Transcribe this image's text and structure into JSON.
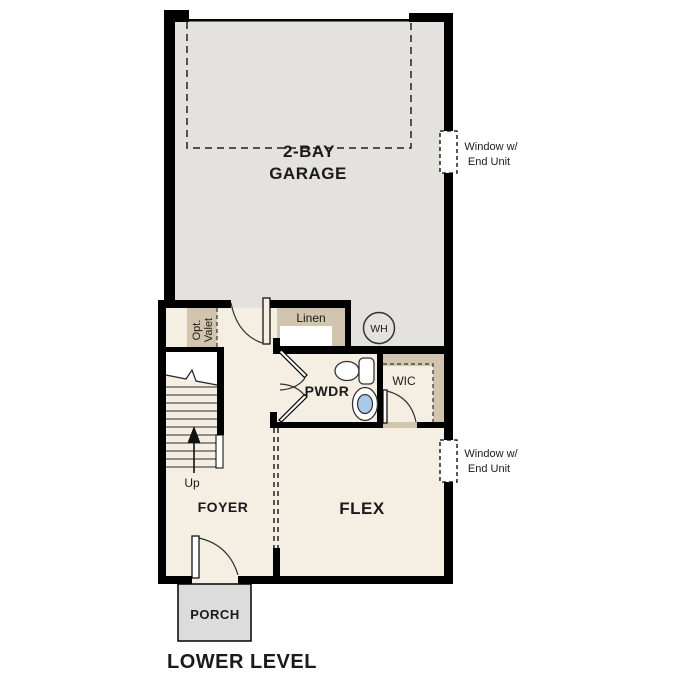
{
  "colors": {
    "garage_floor": "#e3e2df",
    "room_floor": "#f5efe3",
    "closet_tan": "#d2c5ad",
    "porch_gray": "#dcdcdc",
    "sink_blue": "#a9c9e9",
    "wall_black": "#000000",
    "line_dark": "#2a2a2a",
    "text_dark": "#1a1a1a"
  },
  "rooms": {
    "garage": {
      "label_line1": "2-BAY",
      "label_line2": "GARAGE"
    },
    "linen": {
      "label": "Linen"
    },
    "valet": {
      "label_line1": "Opt.",
      "label_line2": "Valet"
    },
    "water_heater": {
      "label": "WH"
    },
    "pwdr": {
      "label": "PWDR"
    },
    "wic": {
      "label": "WIC"
    },
    "stairs": {
      "label": "Up"
    },
    "foyer": {
      "label": "FOYER"
    },
    "flex": {
      "label": "FLEX"
    },
    "porch": {
      "label": "PORCH"
    }
  },
  "annotations": {
    "window_upper": {
      "line1": "Window w/",
      "line2": "End Unit"
    },
    "window_lower": {
      "line1": "Window w/",
      "line2": "End Unit"
    },
    "floor_title": "LOWER LEVEL"
  }
}
